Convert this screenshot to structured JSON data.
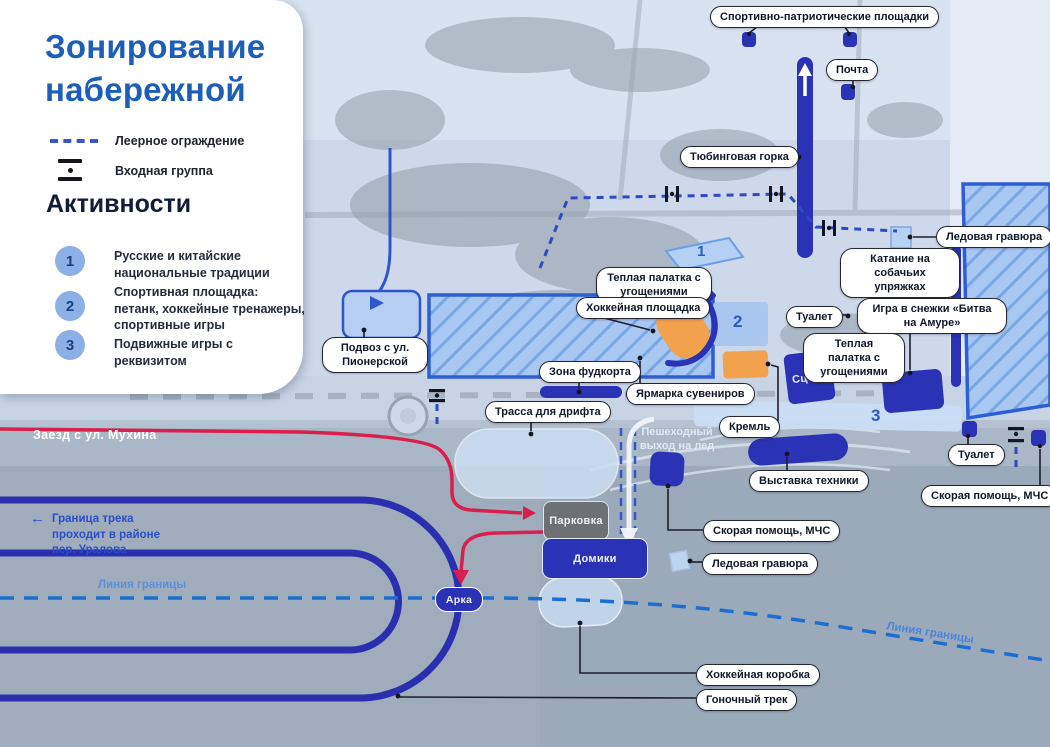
{
  "title": "Зонирование набережной",
  "legend": {
    "fence": "Леерное ограждение",
    "entrance": "Входная группа",
    "activities_title": "Активности",
    "activities": [
      {
        "num": "1",
        "text": "Русские и китайские национальные традиции"
      },
      {
        "num": "2",
        "text": "Спортивная площадка: петанк, хоккейные тренажеры, спортивные игры"
      },
      {
        "num": "3",
        "text": "Подвижные игры с реквизитом"
      }
    ]
  },
  "zones": {
    "z1": "1",
    "z2": "2",
    "z3": "3"
  },
  "labels": {
    "sport_patriotic": "Спортивно-патриотические площадки",
    "post": "Почта",
    "tubing": "Тюбинговая горка",
    "ice_engraving": "Ледовая гравюра",
    "dog_sledding": "Катание на собачьих упряжках",
    "warm_tent": "Теплая палатка с угощениями",
    "hockey_court": "Хоккейная площадка",
    "snowball": "Игра в снежки «Битва на Амуре»",
    "toilet": "Туалет",
    "podvoz": "Подвоз с ул. Пионерской",
    "foodcourt": "Зона фудкорта",
    "souvenir_fair": "Ярмарка сувениров",
    "kremlin": "Кремль",
    "drift_track": "Трасса для дрифта",
    "stage": "Сцена",
    "tech_expo": "Выставка техники",
    "ambulance": "Скорая помощь, МЧС",
    "parking": "Парковка",
    "houses": "Домики",
    "arch": "Арка",
    "hockey_box": "Хоккейная коробка",
    "race_track": "Гоночный трек",
    "mukhina": "Заезд с ул. Мухина",
    "track_note_arrow": "←",
    "track_note": "Граница трека проходит в районе пер. Уралова",
    "boundary_line": "Линия границы",
    "pedestrian_exit": "Пешеходный выход на лед"
  },
  "colors": {
    "primary_blue": "#2a32b5",
    "zone_fill": "#aac8f0",
    "orange": "#f2a14d",
    "route_red": "#d81f4d",
    "fence_blue": "#2f48c4",
    "boundary_blue": "#1d6ed2",
    "title_blue": "#1d5eb8"
  }
}
